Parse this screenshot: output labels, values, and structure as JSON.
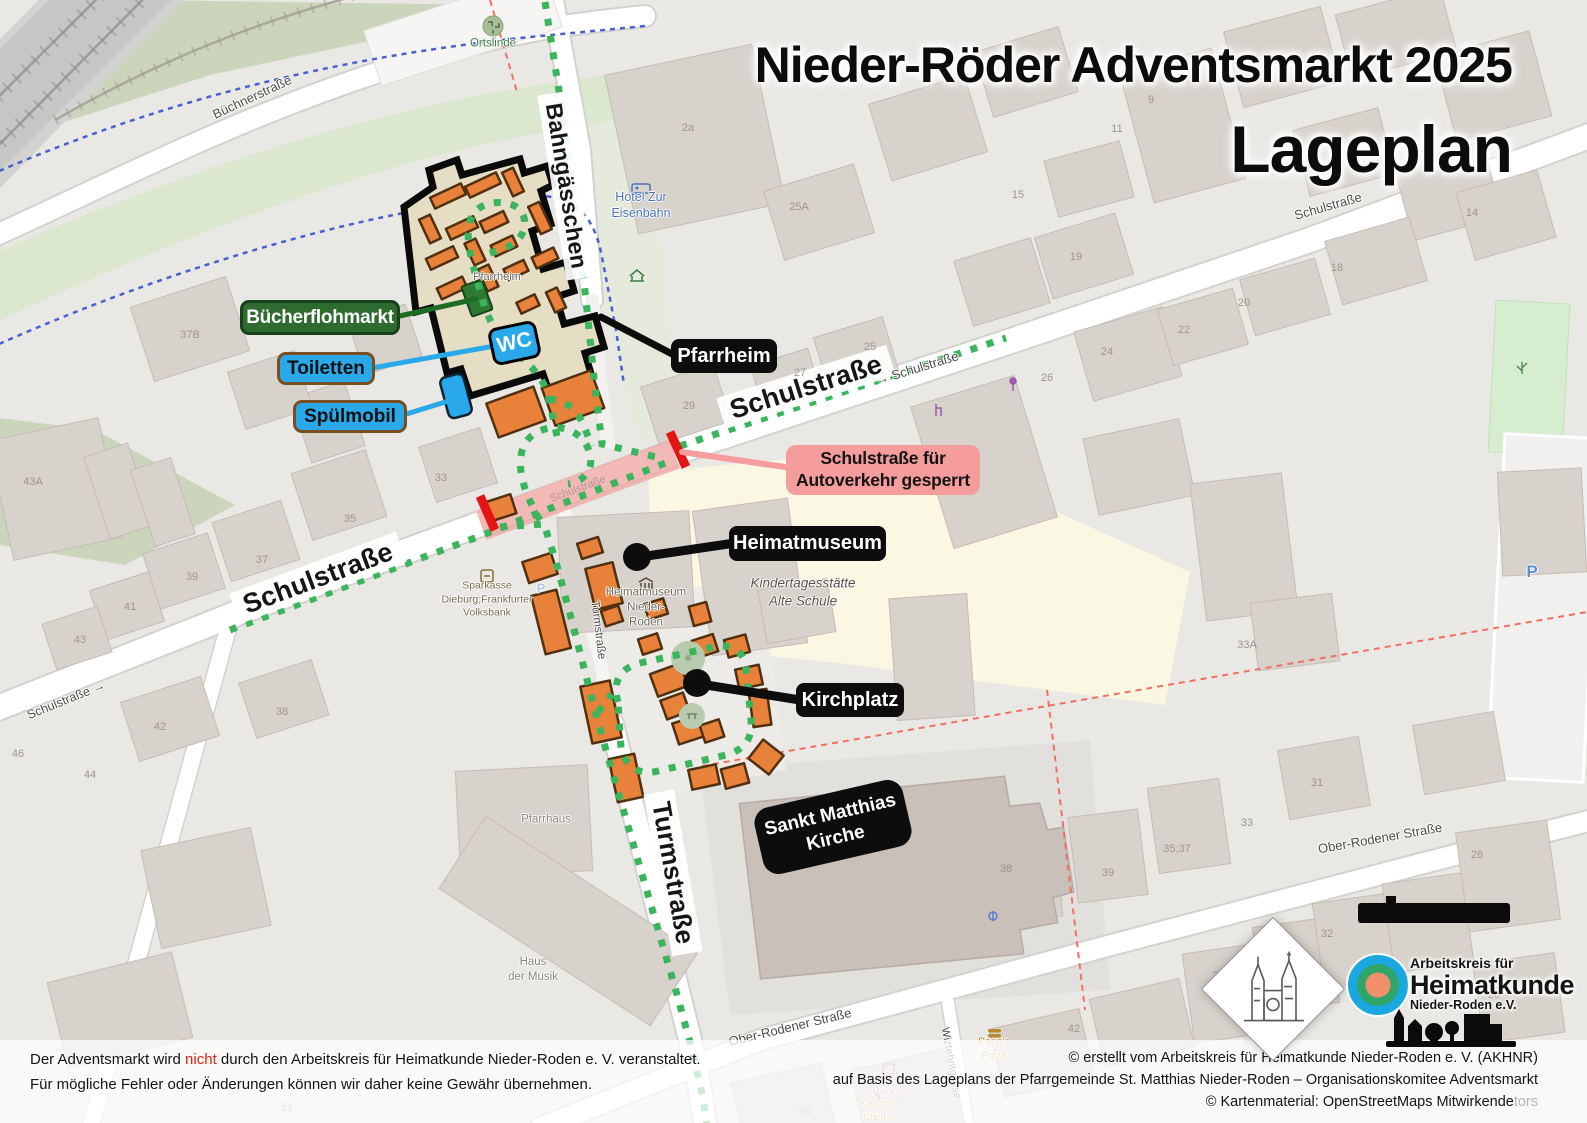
{
  "title": {
    "line1": "Nieder-Röder Adventsmarkt 2025",
    "line2": "Lageplan"
  },
  "callouts": {
    "buecherflohmarkt": "Bücherflohmarkt",
    "toiletten": "Toiletten",
    "spuelmobil": "Spülmobil",
    "wc": "WC",
    "pfarrheim": "Pfarrheim",
    "gesperrt1": "Schulstraße für",
    "gesperrt2": "Autoverkehr gesperrt",
    "heimatmuseum": "Heimatmuseum",
    "kirchplatz": "Kirchplatz",
    "kirche1": "Sankt Matthias",
    "kirche2": "Kirche"
  },
  "map_labels": {
    "street_labels": [
      {
        "t": "Schulstraße",
        "x": 318,
        "y": 578,
        "r": -20.5,
        "s": 27,
        "cls": "big"
      },
      {
        "t": "Schulstraße",
        "x": 806,
        "y": 387,
        "r": -17.5,
        "s": 27,
        "cls": "big"
      },
      {
        "t": "Bahngässchen",
        "x": 566,
        "y": 186,
        "r": 81,
        "s": 23,
        "cls": "big"
      },
      {
        "t": "Turmstraße",
        "x": 673,
        "y": 873,
        "r": 80,
        "s": 26,
        "cls": "big"
      },
      {
        "t": "Schulstraße",
        "x": 1328,
        "y": 206,
        "r": -16,
        "s": 13,
        "cls": "sm"
      },
      {
        "t": "→ Schulstraße",
        "x": 917,
        "y": 368,
        "r": -17,
        "s": 13,
        "cls": "sm"
      },
      {
        "t": "Schulstraße →",
        "x": 66,
        "y": 700,
        "r": -22,
        "s": 12.5,
        "cls": "sm"
      },
      {
        "t": "Büchnerstraße",
        "x": 252,
        "y": 97,
        "r": -25,
        "s": 13,
        "cls": "sm"
      },
      {
        "t": "Ober-Rodener Straße",
        "x": 790,
        "y": 1027,
        "r": -13.5,
        "s": 13,
        "cls": "sm"
      },
      {
        "t": "Ober-Rodener Straße",
        "x": 1380,
        "y": 838,
        "r": -10,
        "s": 13,
        "cls": "sm"
      },
      {
        "t": "Wiztehntgasse",
        "x": 951,
        "y": 1063,
        "r": 80,
        "s": 11,
        "cls": "sm"
      },
      {
        "t": "Turmstraße",
        "x": 598,
        "y": 630,
        "r": 83,
        "s": 11.5,
        "cls": "sm"
      },
      {
        "t": "Schulstraße",
        "x": 578,
        "y": 489,
        "r": -20.5,
        "s": 11,
        "cls": "faint"
      }
    ],
    "house_numbers": [
      {
        "t": "37B",
        "x": 190,
        "y": 335
      },
      {
        "t": "43A",
        "x": 33,
        "y": 482
      },
      {
        "t": "35",
        "x": 350,
        "y": 519
      },
      {
        "t": "37",
        "x": 262,
        "y": 560
      },
      {
        "t": "39",
        "x": 192,
        "y": 577
      },
      {
        "t": "41",
        "x": 130,
        "y": 607
      },
      {
        "t": "43",
        "x": 80,
        "y": 640
      },
      {
        "t": "42",
        "x": 160,
        "y": 727
      },
      {
        "t": "38",
        "x": 282,
        "y": 712
      },
      {
        "t": "33",
        "x": 441,
        "y": 478
      },
      {
        "t": "29",
        "x": 689,
        "y": 406
      },
      {
        "t": "2a",
        "x": 688,
        "y": 128
      },
      {
        "t": "25A",
        "x": 799,
        "y": 207
      },
      {
        "t": "19",
        "x": 1076,
        "y": 257
      },
      {
        "t": "7",
        "x": 1188,
        "y": 81
      },
      {
        "t": "9",
        "x": 1151,
        "y": 100
      },
      {
        "t": "11",
        "x": 1117,
        "y": 129
      },
      {
        "t": "15",
        "x": 1018,
        "y": 195
      },
      {
        "t": "14",
        "x": 1472,
        "y": 213
      },
      {
        "t": "18",
        "x": 1337,
        "y": 268
      },
      {
        "t": "25",
        "x": 870,
        "y": 347
      },
      {
        "t": "27",
        "x": 800,
        "y": 373
      },
      {
        "t": "24",
        "x": 1107,
        "y": 352
      },
      {
        "t": "26",
        "x": 1047,
        "y": 378
      },
      {
        "t": "22",
        "x": 1184,
        "y": 330
      },
      {
        "t": "20",
        "x": 1244,
        "y": 303
      },
      {
        "t": "33A",
        "x": 1247,
        "y": 645
      },
      {
        "t": "31",
        "x": 1317,
        "y": 783
      },
      {
        "t": "35;37",
        "x": 1177,
        "y": 849
      },
      {
        "t": "39",
        "x": 1108,
        "y": 873
      },
      {
        "t": "33",
        "x": 1247,
        "y": 823
      },
      {
        "t": "26",
        "x": 1477,
        "y": 855
      },
      {
        "t": "30",
        "x": 1400,
        "y": 920
      },
      {
        "t": "32",
        "x": 1327,
        "y": 934
      },
      {
        "t": "34",
        "x": 1275,
        "y": 954
      },
      {
        "t": "36",
        "x": 1219,
        "y": 976
      },
      {
        "t": "28",
        "x": 1494,
        "y": 995
      },
      {
        "t": "38",
        "x": 1006,
        "y": 869
      },
      {
        "t": "44",
        "x": 90,
        "y": 775
      },
      {
        "t": "46",
        "x": 18,
        "y": 754
      },
      {
        "t": "49",
        "x": 275,
        "y": 1055
      },
      {
        "t": "51",
        "x": 287,
        "y": 1108
      },
      {
        "t": "50",
        "x": 805,
        "y": 1112
      },
      {
        "t": "42",
        "x": 1074,
        "y": 1029
      }
    ],
    "pois": [
      {
        "lines": [
          "Ortslinde"
        ],
        "x": 493,
        "y": 44,
        "c": "#3E7A3E",
        "s": 11.5
      },
      {
        "lines": [
          "Hotel Zur",
          "Eisenbahn"
        ],
        "x": 641,
        "y": 205,
        "c": "#4A72B8",
        "s": 12.5
      },
      {
        "lines": [
          "Pfarrheim"
        ],
        "x": 497,
        "y": 277,
        "c": "#6E695F",
        "s": 11
      },
      {
        "lines": [
          "Sparkasse",
          "Dieburg;Frankfurter",
          "Volksbank"
        ],
        "x": 487,
        "y": 600,
        "c": "#7A6A50",
        "s": 10.5
      },
      {
        "lines": [
          "Heimatmuseum",
          "Nieder-",
          "Roden"
        ],
        "x": 646,
        "y": 608,
        "c": "#6E695F",
        "s": 11.5
      },
      {
        "lines": [
          "Kindertagesstätte",
          "Alte Schule"
        ],
        "x": 803,
        "y": 592,
        "c": "#55534B",
        "s": 13.5,
        "i": 1
      },
      {
        "lines": [
          "Pfarrhaus"
        ],
        "x": 546,
        "y": 820,
        "c": "#8A857B",
        "s": 11.5
      },
      {
        "lines": [
          "Haus",
          "der Musik"
        ],
        "x": 533,
        "y": 970,
        "c": "#8A857B",
        "s": 11.5
      },
      {
        "lines": [
          "Trinkhalle",
          "Roden"
        ],
        "x": 888,
        "y": 1085,
        "c": "#B07AB0",
        "s": 10.5
      },
      {
        "lines": [
          "Papa's",
          "Pizza"
        ],
        "x": 994,
        "y": 1049,
        "c": "#B8892F",
        "s": 10.5
      },
      {
        "lines": [
          "Karizma",
          "Shisha"
        ],
        "x": 879,
        "y": 1111,
        "c": "#B8892F",
        "s": 10.5
      },
      {
        "lines": [
          "P"
        ],
        "x": 1532,
        "y": 572,
        "c": "#5A8FD0",
        "s": 17,
        "b": 1
      },
      {
        "lines": [
          "P"
        ],
        "x": 541,
        "y": 589,
        "c": "#A9C4E4",
        "s": 13,
        "b": 1
      }
    ]
  },
  "footer": {
    "left1a": "Der Adventsmarkt wird ",
    "left1b": "nicht",
    "left1c": " durch den Arbeitskreis für Heimatkunde Nieder-Roden e. V. veranstaltet.",
    "left2": "Für mögliche Fehler oder Änderungen können wir daher keine Gewähr übernehmen.",
    "right1": "© erstellt vom Arbeitskreis für Heimatkunde Nieder-Roden e. V. (AKHNR)",
    "right2": "auf Basis des Lageplans der Pfarrgemeinde St. Matthias Nieder-Roden – Organisationskomitee Adventsmarkt",
    "right3": "© Kartenmaterial: OpenStreetMaps Mitwirkende",
    "attribution_fragment": "tors"
  },
  "logo": {
    "line1": "Arbeitskreis für",
    "line2": "Heimatkunde",
    "line3": "Nieder-Roden e.V."
  },
  "colors": {
    "stall": "#E8823B",
    "path_dots": "#3BB55D",
    "blocked_bar": "#E51414",
    "callout_blue": "#29A9E9",
    "callout_green": "#2E6B2E",
    "callout_pink": "#F59C9C",
    "callout_black": "#0D0D0D",
    "pfarrheim_fill": "#E5DDC4",
    "logo_blue": "#1BA7E0",
    "logo_green": "#2FA567",
    "logo_orange": "#F2906B"
  }
}
